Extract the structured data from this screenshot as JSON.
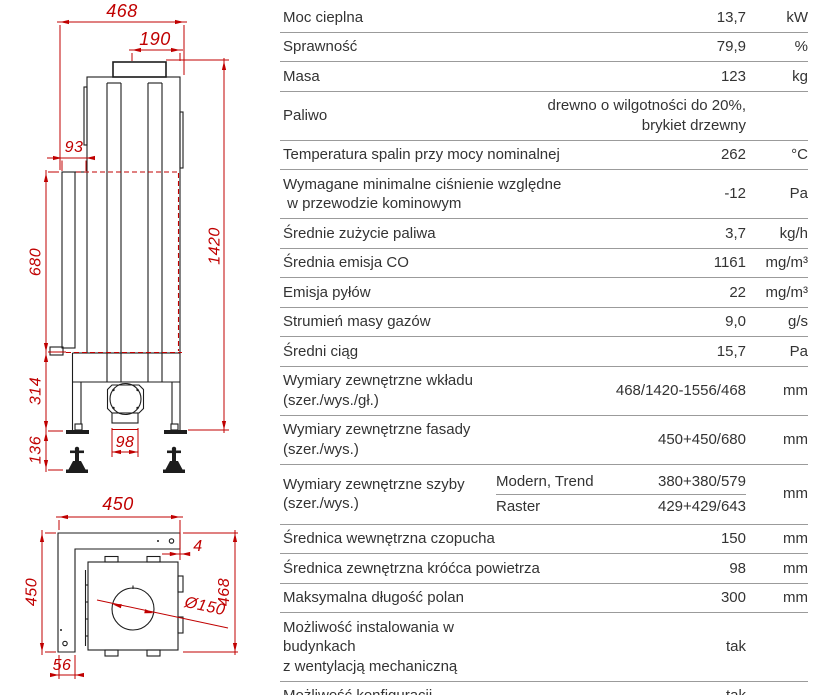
{
  "drawing": {
    "accent_color": "#c00000",
    "line_color": "#1d1d1d",
    "front_view": {
      "dims": {
        "total_width": "468",
        "flue_offset": "190",
        "left_inset": "93",
        "total_height": "1420",
        "facade_height": "680",
        "base_height": "314",
        "feet_height": "136",
        "inlet_width": "98"
      }
    },
    "top_view": {
      "dims": {
        "facade_width": "450",
        "facade_depth": "450",
        "panel_gap": "4",
        "body_depth": "468",
        "inlet_diameter": "Ø150",
        "left_offset": "56"
      }
    }
  },
  "spec_table": {
    "rows": [
      {
        "label": "Moc cieplna",
        "value": "13,7",
        "unit": "kW"
      },
      {
        "label": "Sprawność",
        "value": "79,9",
        "unit": "%"
      },
      {
        "label": "Masa",
        "value": "123",
        "unit": "kg"
      },
      {
        "label": "Paliwo",
        "value": "drewno o wilgotności do 20%,\nbrykiet drzewny",
        "unit": ""
      },
      {
        "label": "Temperatura spalin przy mocy nominalnej",
        "value": "262",
        "unit": "°C"
      },
      {
        "label": "Wymagane minimalne ciśnienie względne\n w przewodzie kominowym",
        "value": "-12",
        "unit": "Pa"
      },
      {
        "label": "Średnie zużycie paliwa",
        "value": "3,7",
        "unit": "kg/h"
      },
      {
        "label": "Średnia emisja CO",
        "value": "1161",
        "unit": "mg/m³"
      },
      {
        "label": "Emisja pyłów",
        "value": "22",
        "unit": "mg/m³"
      },
      {
        "label": "Strumień masy gazów",
        "value": "9,0",
        "unit": "g/s"
      },
      {
        "label": "Średni ciąg",
        "value": "15,7",
        "unit": "Pa"
      },
      {
        "label": "Wymiary zewnętrzne wkładu\n(szer./wys./gł.)",
        "value": "468/1420-1556/468",
        "unit": "mm"
      },
      {
        "label": "Wymiary zewnętrzne fasady\n(szer./wys.)",
        "value": "450+450/680",
        "unit": "mm"
      },
      {
        "label": "Wymiary zewnętrzne szyby\n(szer./wys.)",
        "unit": "mm",
        "variants": [
          {
            "name": "Modern, Trend",
            "value": "380+380/579"
          },
          {
            "name": "Raster",
            "value": "429+429/643"
          }
        ]
      },
      {
        "label": "Średnica wewnętrzna czopucha",
        "value": "150",
        "unit": "mm"
      },
      {
        "label": "Średnica zewnętrzna króćca powietrza",
        "value": "98",
        "unit": "mm"
      },
      {
        "label": "Maksymalna długość polan",
        "value": "300",
        "unit": "mm"
      },
      {
        "label": "Możliwość instalowania w budynkach\nz wentylacją mechaniczną",
        "value": "tak",
        "unit": ""
      },
      {
        "label": "Możliwość konfiguracji",
        "value": "tak",
        "unit": ""
      }
    ]
  }
}
